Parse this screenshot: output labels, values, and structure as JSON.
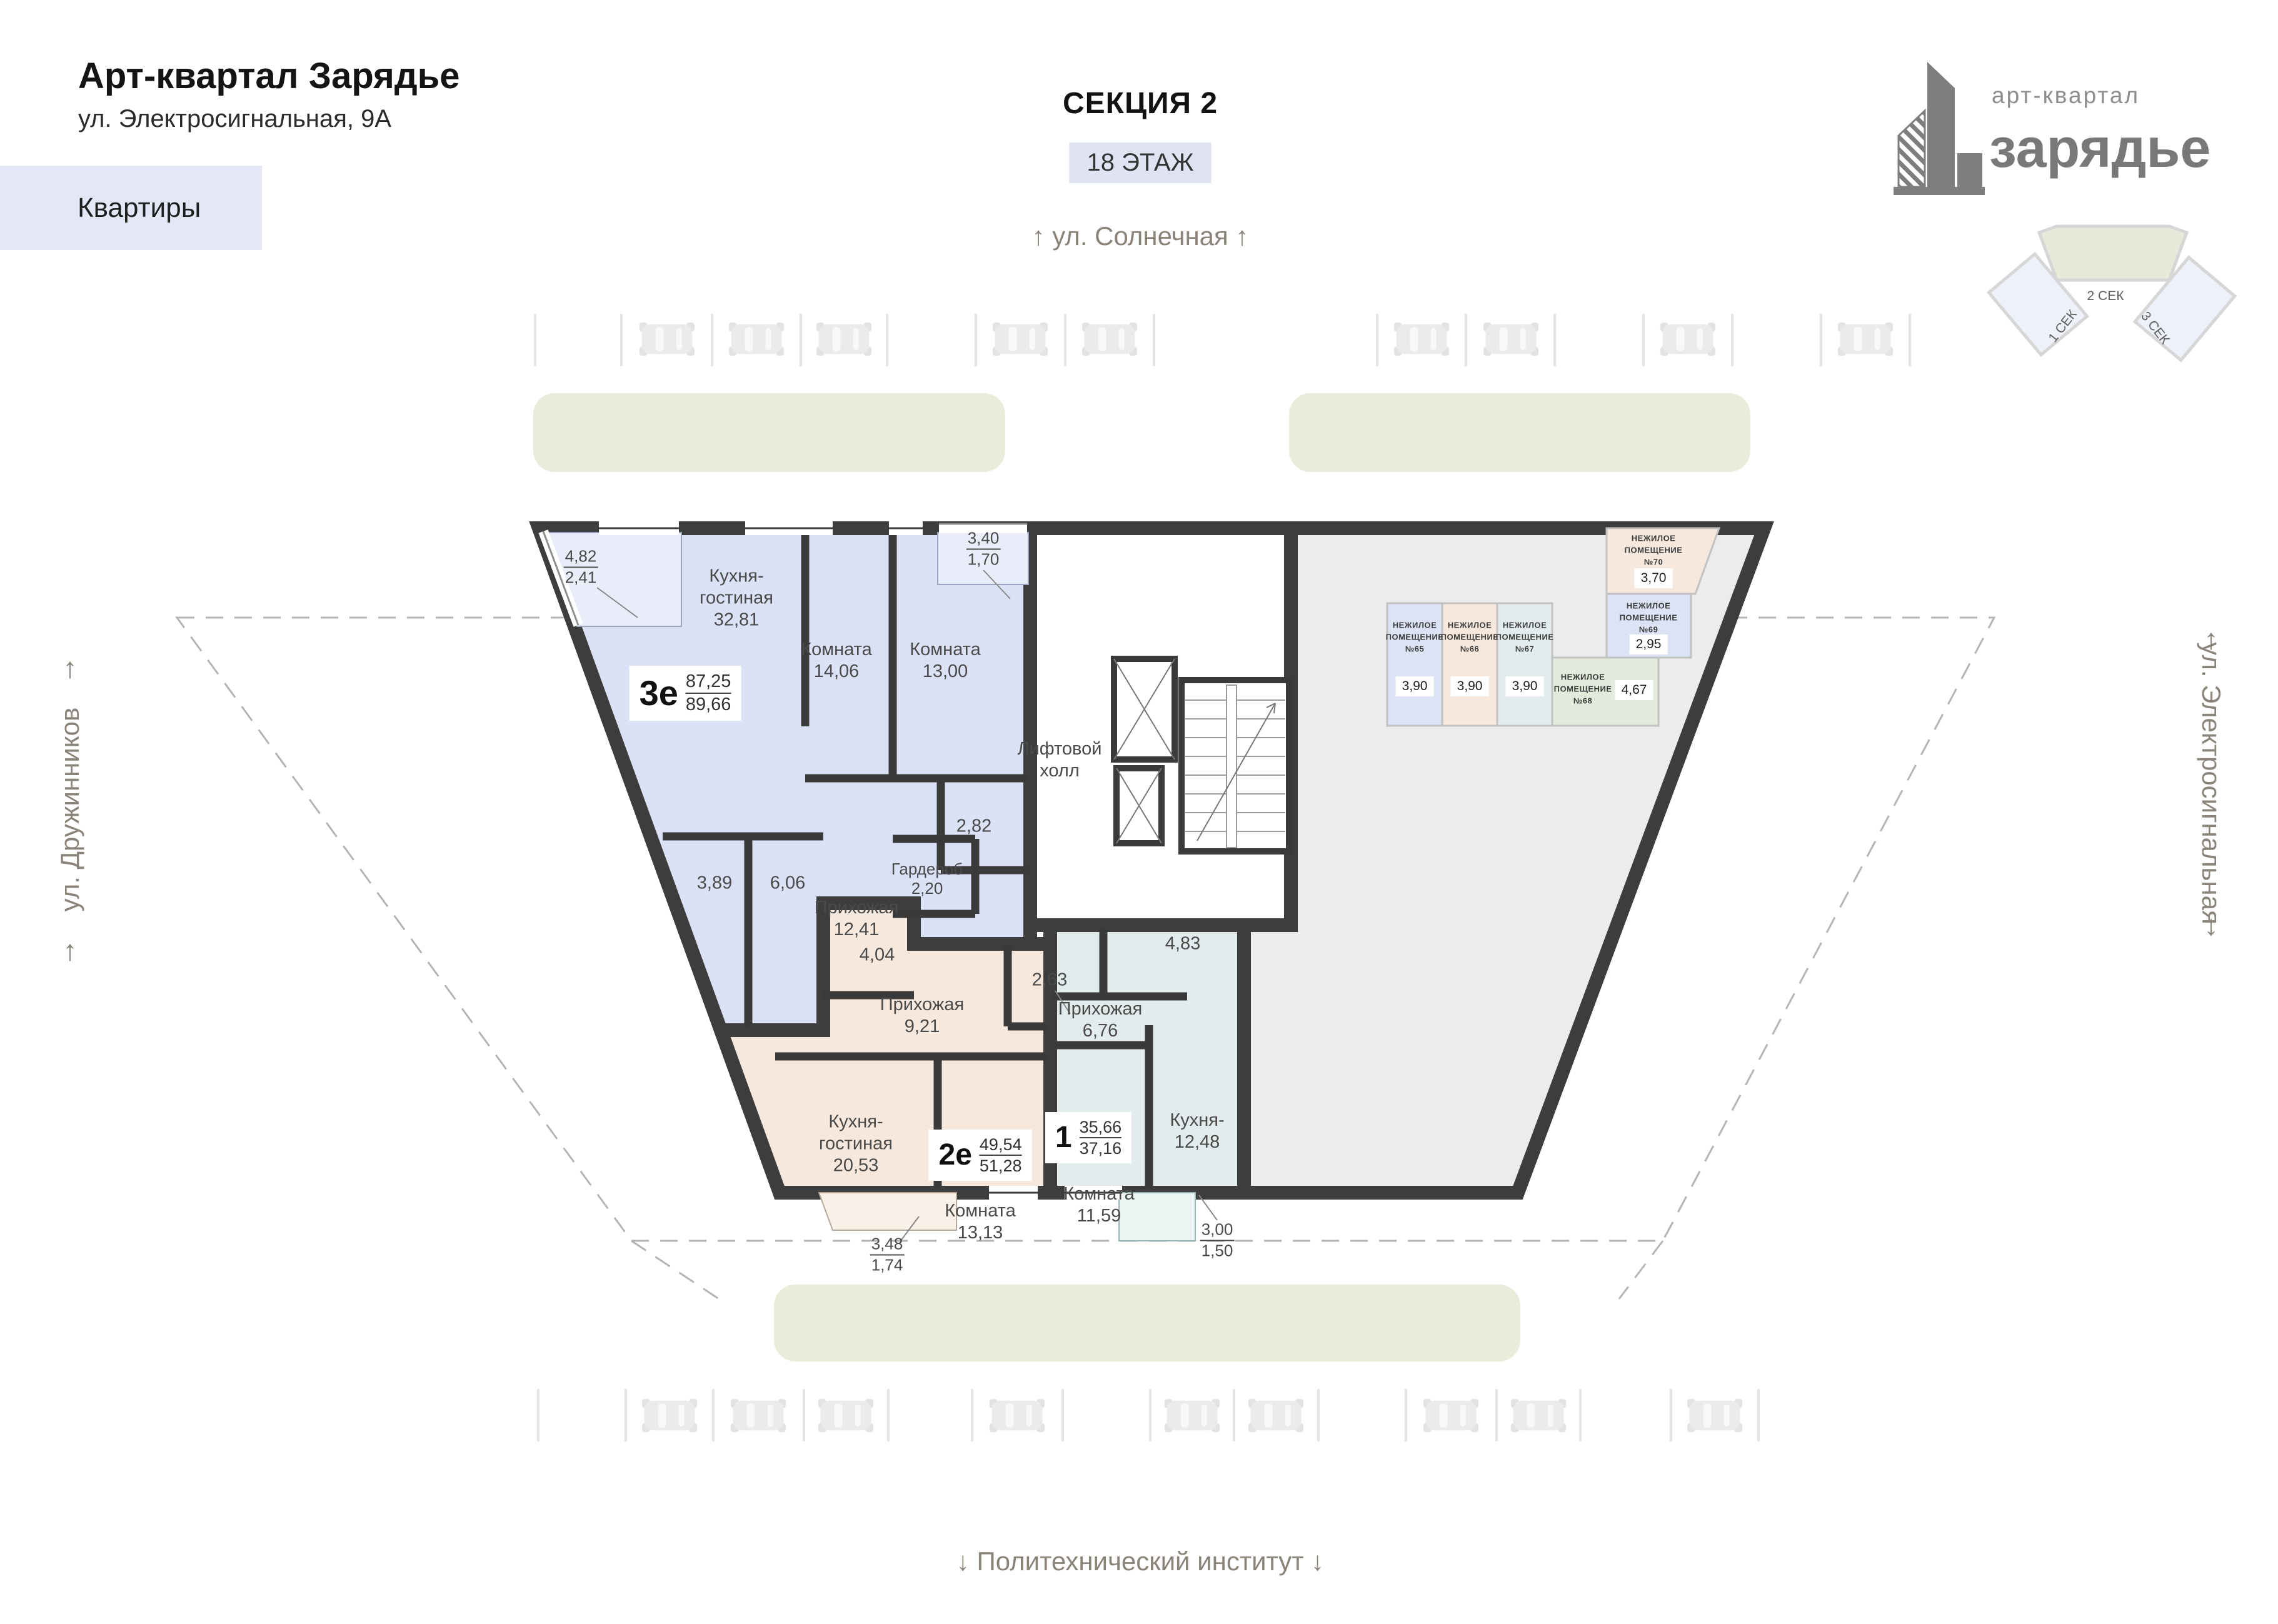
{
  "header": {
    "title": "Арт-квартал Зарядье",
    "address": "ул. Электросигнальная, 9А",
    "tab_label": "Квартиры"
  },
  "section": {
    "name": "СЕКЦИЯ 2",
    "floor": "18 ЭТАЖ"
  },
  "logo": {
    "top": "арт-квартал",
    "bottom": "зарядье"
  },
  "minimap": {
    "left": "1 СЕК",
    "center": "2 СЕК",
    "right": "3 СЕК"
  },
  "streets": {
    "top": "ул. Солнечная",
    "bottom": "Политехнический институт",
    "left": "ул. Дружинников",
    "right": "ул. Электросигнальная",
    "arrow_up": "↑",
    "arrow_down": "↓"
  },
  "plan": {
    "hall1": "Лифтовой",
    "hall2": "холл",
    "apartments": [
      {
        "code": "3е",
        "a1": "87,25",
        "a2": "89,66"
      },
      {
        "code": "2е",
        "a1": "49,54",
        "a2": "51,28"
      },
      {
        "code": "1",
        "a1": "35,66",
        "a2": "37,16"
      }
    ],
    "rooms": [
      {
        "n1": "Кухня-",
        "n2": "гостиная",
        "v": "32,81"
      },
      {
        "n1": "Комната",
        "v": "14,06"
      },
      {
        "n1": "Комната",
        "v": "13,00"
      },
      {
        "n1": "Прихожая",
        "v": "12,41"
      },
      {
        "n1": "Гардероб",
        "v": "2,20"
      },
      {
        "v": "2,82"
      },
      {
        "v": "3,89"
      },
      {
        "v": "6,06"
      },
      {
        "v1": "4,82",
        "v2": "2,41"
      },
      {
        "v1": "3,40",
        "v2": "1,70"
      },
      {
        "v": "4,04"
      },
      {
        "n1": "Прихожая",
        "v": "9,21"
      },
      {
        "v": "2,63"
      },
      {
        "n1": "Кухня-",
        "n2": "гостиная",
        "v": "20,53"
      },
      {
        "n1": "Комната",
        "v": "13,13"
      },
      {
        "v1": "3,48",
        "v2": "1,74"
      },
      {
        "n1": "Прихожая",
        "v": "6,76"
      },
      {
        "v": "4,83"
      },
      {
        "n1": "Кухня-",
        "v": "12,48"
      },
      {
        "n1": "Комната",
        "v": "11,59"
      },
      {
        "v1": "3,00",
        "v2": "1,50"
      }
    ]
  },
  "nonres": {
    "l1": "НЕЖИЛОЕ",
    "l2": "ПОМЕЩЕНИЕ",
    "units": [
      {
        "num": "№65",
        "v": "3,90"
      },
      {
        "num": "№66",
        "v": "3,90"
      },
      {
        "num": "№67",
        "v": "3,90"
      },
      {
        "num": "№68",
        "v": "4,67"
      },
      {
        "num": "№69",
        "v": "2,95"
      },
      {
        "num": "№70",
        "v": "3,70"
      }
    ]
  }
}
